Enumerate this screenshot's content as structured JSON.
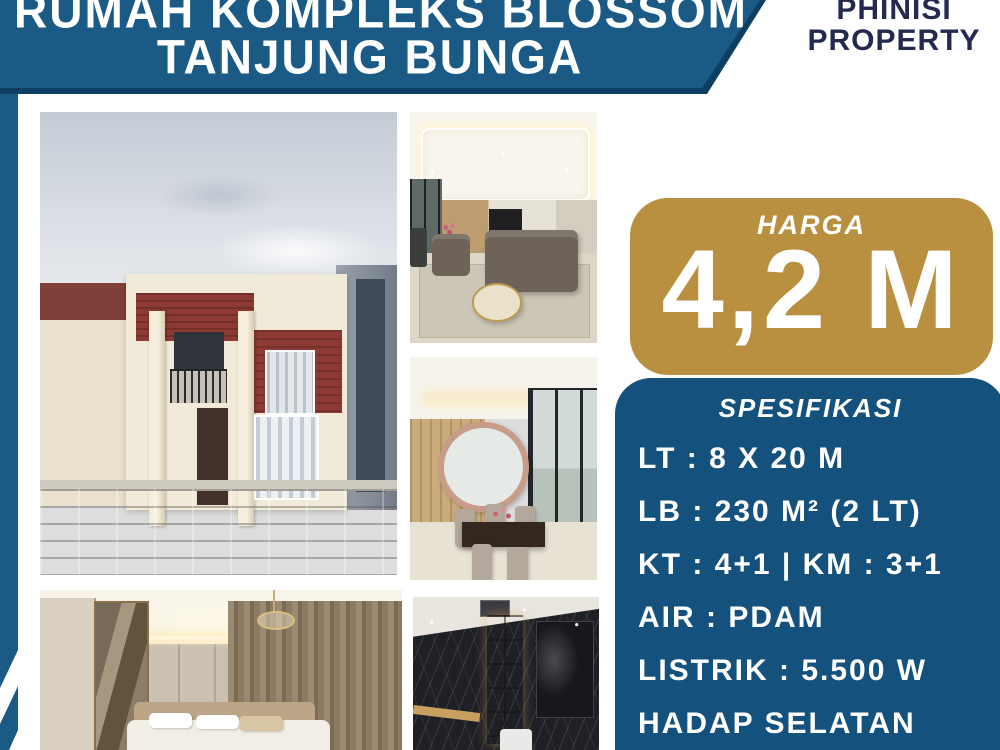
{
  "banner": {
    "title_line1": "RUMAH KOMPLEKS BLOSSOM",
    "title_line2": "TANJUNG BUNGA"
  },
  "brand": {
    "line1": "PHINISI",
    "line2": "PROPERTY"
  },
  "price": {
    "label": "HARGA",
    "value": "4,2 M"
  },
  "specs": {
    "heading": "SPESIFIKASI",
    "items": [
      "LT : 8 X 20 M",
      "LB : 230 M² (2 LT)",
      "KT : 4+1 | KM : 3+1",
      "AIR : PDAM",
      "LISTRIK : 5.500 W",
      "HADAP SELATAN"
    ]
  },
  "photos": [
    {
      "name": "house-exterior"
    },
    {
      "name": "living-room"
    },
    {
      "name": "dining-room"
    },
    {
      "name": "bedroom"
    },
    {
      "name": "bathroom"
    }
  ],
  "colors": {
    "banner_blue": "#1a5a84",
    "banner_edge_navy": "#0d3f63",
    "spec_blue": "#14517c",
    "gold": "#b8903f",
    "brand_navy": "#23294f",
    "text_white": "#ffffff"
  }
}
